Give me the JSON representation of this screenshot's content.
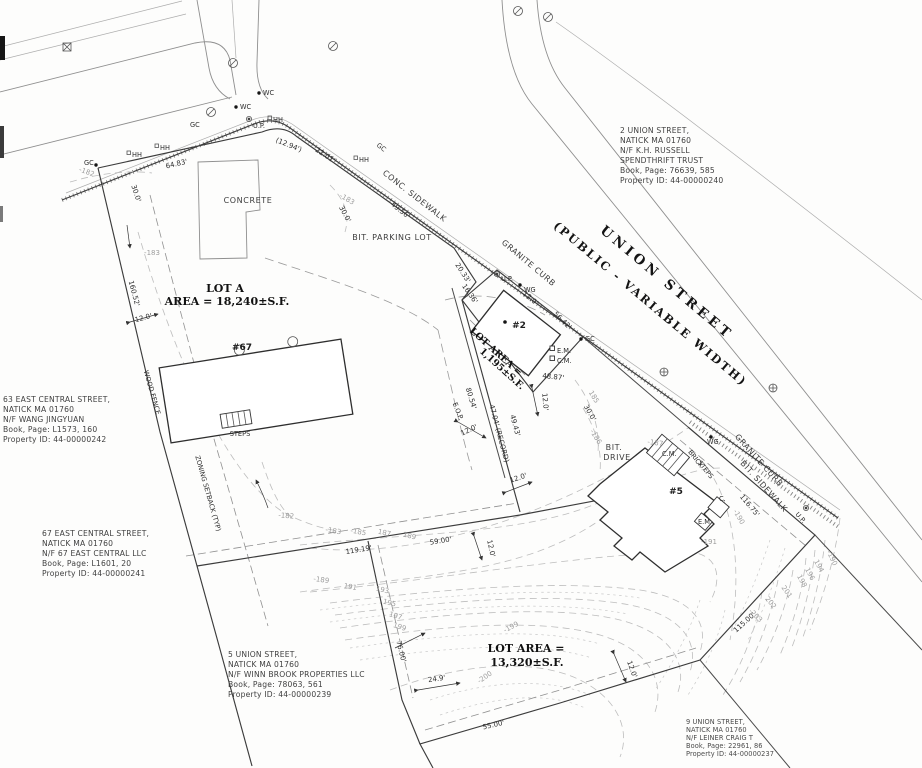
{
  "drawing": {
    "street": {
      "name": "UNION STREET",
      "designation": "(PUBLIC - VARIABLE WIDTH)"
    },
    "lots": {
      "lot_a": {
        "title": "LOT A",
        "area": "AREA = 18,240±S.F.",
        "building_no": "#67"
      },
      "lot_2": {
        "area_label": "LOT AREA =",
        "area_value": "1,195±S.F.",
        "building_no": "#2"
      },
      "lot_5": {
        "area_label": "LOT AREA =",
        "area_value": "13,320±S.F.",
        "building_no": "#5"
      }
    },
    "abutters": [
      {
        "id": "2-union-street",
        "lines": [
          "2 UNION STREET,",
          "NATICK MA 01760",
          "N/F K.H. RUSSELL",
          "SPENDTHRIFT TRUST",
          "Book, Page: 76639, 585",
          "Property ID: 44-00000240"
        ]
      },
      {
        "id": "63-east-central-street",
        "lines": [
          "63 EAST CENTRAL STREET,",
          "NATICK MA 01760",
          "N/F  WANG JINGYUAN",
          "Book, Page: L1573, 160",
          "Property ID: 44-00000242"
        ]
      },
      {
        "id": "67-east-central-street",
        "lines": [
          "67 EAST CENTRAL STREET,",
          "NATICK MA 01760",
          "N/F 67 EAST CENTRAL LLC",
          "Book, Page: L1601, 20",
          "Property ID: 44-00000241"
        ]
      },
      {
        "id": "5-union-street",
        "lines": [
          "5 UNION STREET,",
          "NATICK MA 01760",
          "N/F WINN BROOK PROPERTIES LLC",
          "Book, Page: 78063, 561",
          "Property ID: 44-00000239"
        ]
      },
      {
        "id": "9-union-street",
        "lines": [
          "9 UNION STREET,",
          "NATICK MA 01760",
          "N/F LEINER CRAIG T",
          "Book, Page: 22961, 86",
          "Property ID: 44-00000237"
        ]
      }
    ],
    "features": {
      "concrete": "CONCRETE",
      "bit_parking_lot": "BIT. PARKING LOT",
      "conc_sidewalk": "CONC. SIDEWALK",
      "granite_curb_upper": "GRANITE CURB",
      "granite_curb_lower": "GRANITE CURB",
      "bit_sidewalk": "BIT. SIDEWALK",
      "bit_drive_line1": "BIT.",
      "bit_drive_line2": "DRIVE",
      "wood_fence": "WOOD FENCE",
      "zoning_setback": "ZONING SETBACK (TYP)",
      "steps": "STEPS",
      "brick": "BRICK",
      "brick_steps": "STEPS",
      "eop": "E.O.P."
    },
    "dimensions": {
      "d64_83": "64.83'",
      "d12_94": "(12.94')",
      "d22_01": "22.01'",
      "d49_56": "49.56'",
      "d30_0_west": "30.0'",
      "d30_0_mid": "30.0'",
      "d30_0_east": "30.0'",
      "d160_52": "160.52'",
      "d12_0_a": "12.0'",
      "d12_0_b": "12.0'",
      "d12_0_c": "12.0'",
      "d12_0_d": "12.0'",
      "d12_0_e": "12.0'",
      "d12_0_f": "12.0'",
      "d12_0_g": "12.0'",
      "d20_33": "20.33'",
      "d16_36": "16.36'",
      "d56_42": "56.42'",
      "d48_87": "48.87'",
      "d80_54": "80.54'",
      "d47_04": "47.04' (RECORD)",
      "d49_43": "49.43'",
      "d119_19": "119.19'",
      "d59_00": "59.00'",
      "d76_00": "76.00'",
      "d24_9": "24.9'",
      "d55_00": "55.00'",
      "d115_00": "115.00'",
      "d116_75": "116.75'"
    },
    "contours": {
      "c182_road": "-182",
      "c182_mid": "-182",
      "c183_fence": "-183",
      "c183_lot": "-183",
      "c183_south": "-183",
      "c185_south": "-185",
      "c185_mid": "185",
      "c186_mid": "-186",
      "c187_south": "187",
      "c187_drive": "-187",
      "c189_south": "189",
      "c189_low": "-189",
      "c190_mid": "-190",
      "c190_east": "-190",
      "c191_low": "191",
      "c191_right": "-191",
      "c193": "193",
      "c195": "195",
      "c197": "197",
      "c199": "199",
      "c199_up": "-199",
      "c200": "-200",
      "c194": "194",
      "c196": "196",
      "c198": "198",
      "c201": "201",
      "c202": "202",
      "c203": "-203"
    },
    "utilities": {
      "up_a": "U.P.",
      "up_b": "U.P.",
      "up_c": "U.P.",
      "wc_a": "WC",
      "wc_b": "WC",
      "wg_a": "WG",
      "wg_b": "WG",
      "gc_a": "GC",
      "gc_b": "GC",
      "gc_c": "GC",
      "gc_d": "GC",
      "hh_a": "HH",
      "hh_b": "HH",
      "hh_c": "HH",
      "hh_d": "HH",
      "em_a": "E.M.",
      "cm_a": "C.M.",
      "cm_b": "C.M.",
      "em_b": "E.M",
      "c_b": "C."
    }
  }
}
